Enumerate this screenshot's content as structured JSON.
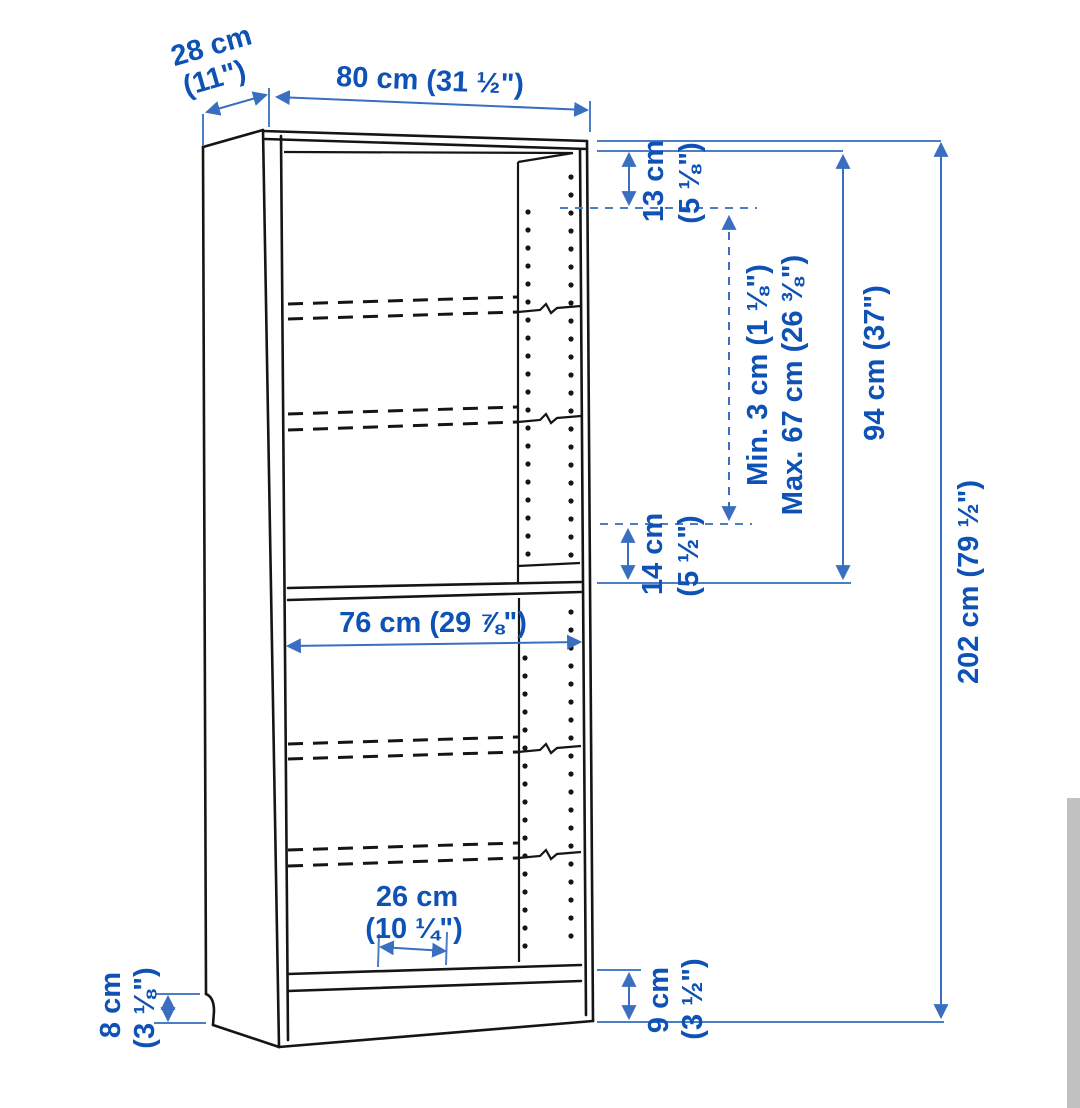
{
  "diagram": {
    "type": "furniture-dimension-diagram",
    "subject": "bookcase with adjustable shelves",
    "colors": {
      "label_blue": "#0f52b5",
      "dimension_line_blue": "#3a6ec0",
      "drawing_black": "#151515",
      "background": "#ffffff",
      "scrollbar_gray": "#c1c1c1"
    },
    "dimensions": {
      "depth": {
        "metric": "28 cm",
        "imperial": "(11\")"
      },
      "width": {
        "text": "80 cm (31 ½\")"
      },
      "top_shelf_gap": {
        "metric": "13 cm",
        "imperial": "(5 ⅛\")"
      },
      "shelf_adjust_min": {
        "text": "Min. 3 cm (1 ⅛\")"
      },
      "shelf_adjust_max": {
        "text": "Max. 67 cm (26 ⅜\")"
      },
      "upper_section_height": {
        "text": "94 cm (37\")"
      },
      "total_height": {
        "text": "202 cm (79 ½\")"
      },
      "middle_shelf_gap": {
        "metric": "14 cm",
        "imperial": "(5 ½\")"
      },
      "inner_width": {
        "text": "76 cm (29 ⅞\")"
      },
      "bottom_inset": {
        "metric": "26 cm",
        "imperial": "(10 ¼\")"
      },
      "plinth_left": {
        "metric": "8 cm",
        "imperial": "(3 ⅛\")"
      },
      "plinth_right": {
        "metric": "9 cm",
        "imperial": "(3 ½\")"
      }
    }
  }
}
